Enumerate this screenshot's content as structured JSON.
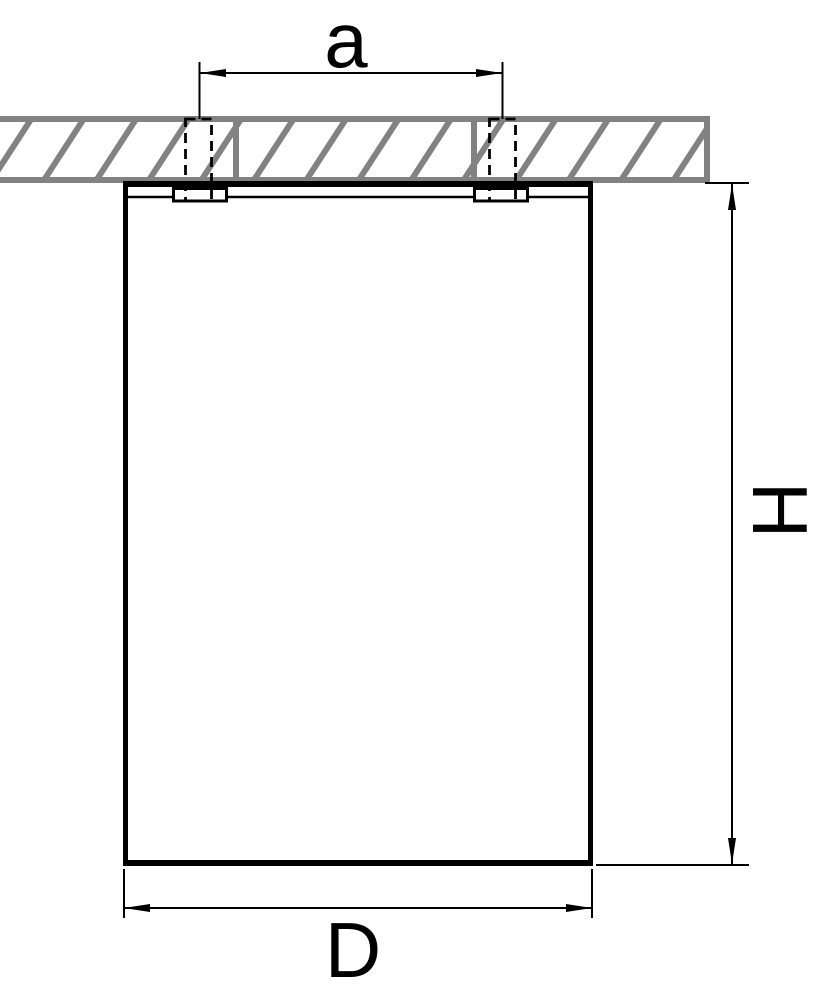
{
  "drawing": {
    "labels": {
      "a": "a",
      "h": "H",
      "d": "D"
    },
    "colors": {
      "line": "#000000",
      "hatch": "#828282",
      "background": "#ffffff"
    }
  }
}
